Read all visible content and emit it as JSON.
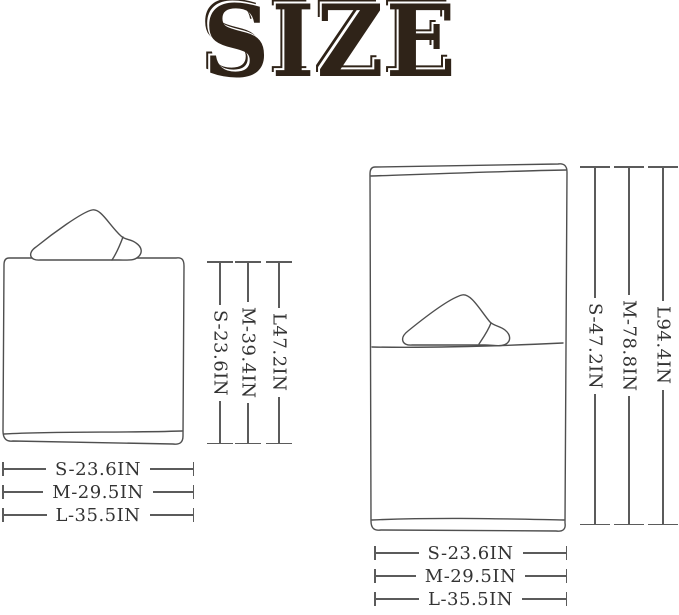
{
  "title": "SIZE",
  "colors": {
    "title_ink": "#2f2318",
    "line": "#5b5b5b",
    "text": "#333333",
    "background": "#ffffff"
  },
  "folded_towel": {
    "vertical_dims": [
      "S-23.6IN",
      "M-39.4IN",
      "L47.2IN"
    ],
    "horizontal_dims": [
      "S-23.6IN",
      "M-29.5IN",
      "L-35.5IN"
    ]
  },
  "unfolded_towel": {
    "vertical_dims": [
      "S-47.2IN",
      "M-78.8IN",
      "L94.4IN"
    ],
    "horizontal_dims": [
      "S-23.6IN",
      "M-29.5IN",
      "L-35.5IN"
    ]
  }
}
